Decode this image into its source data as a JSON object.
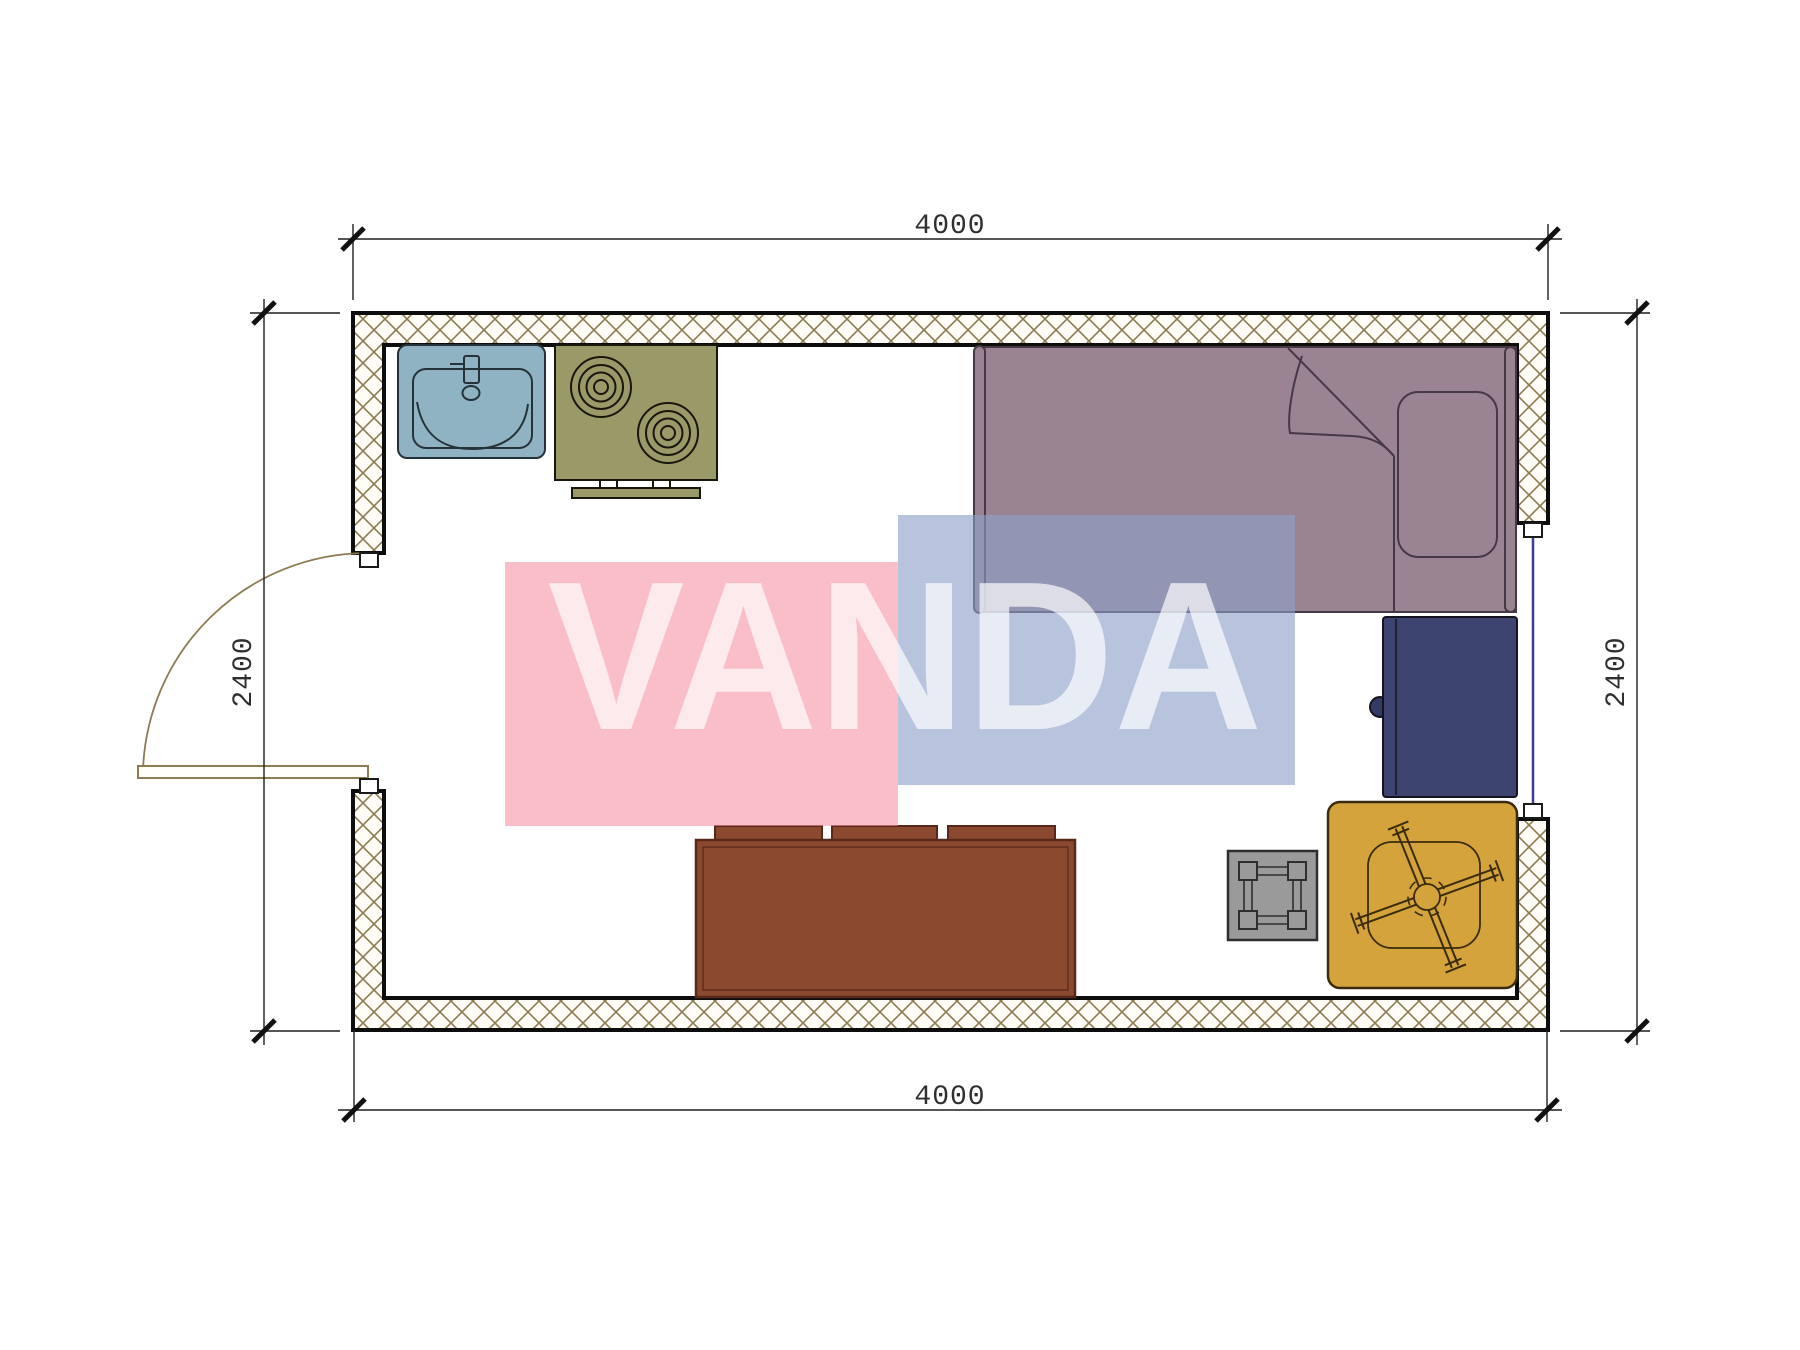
{
  "drawing": {
    "type": "architectural floor plan, top view",
    "room_exterior_width_mm": 4000,
    "room_exterior_depth_mm": 2400
  },
  "dimensions": {
    "top": "4000",
    "bottom": "4000",
    "left": "2400",
    "right": "2400"
  },
  "watermark": {
    "text": "VANDA",
    "pink_block_color": "#f491a2",
    "blue_block_color": "#8ca0c8",
    "text_color": "#ffffff"
  },
  "plan": {
    "wall_hatch_line_color": "#8d7b52",
    "wall_outline_color": "#0d0d0d",
    "window_glass_color": "#3a3f8f",
    "door_arc_color": "#8d7b52",
    "furniture": [
      {
        "name": "sink",
        "color": "#8fb3c2",
        "location": "top-left against north wall"
      },
      {
        "name": "cooktop-stove",
        "color": "#9a9a68",
        "location": "top-left, right of sink, two burners"
      },
      {
        "name": "single-bed",
        "color": "#9b8492",
        "location": "top-right, pillow at east end, folded blanket corner"
      },
      {
        "name": "wardrobe",
        "color": "#3e4470",
        "location": "right side below bed, knob on west face"
      },
      {
        "name": "table",
        "color": "#8b4a2f",
        "location": "bottom-center against south wall, three seat tabs"
      },
      {
        "name": "stool",
        "color": "#9a9a9a",
        "location": "bottom-right of center, four corner legs"
      },
      {
        "name": "desk-chair",
        "color": "#d5a33c",
        "location": "bottom-right corner, star base"
      }
    ],
    "openings": [
      {
        "name": "door",
        "side": "west wall",
        "swing": "quarter-circle arc into room"
      },
      {
        "name": "window",
        "side": "east wall"
      }
    ]
  }
}
